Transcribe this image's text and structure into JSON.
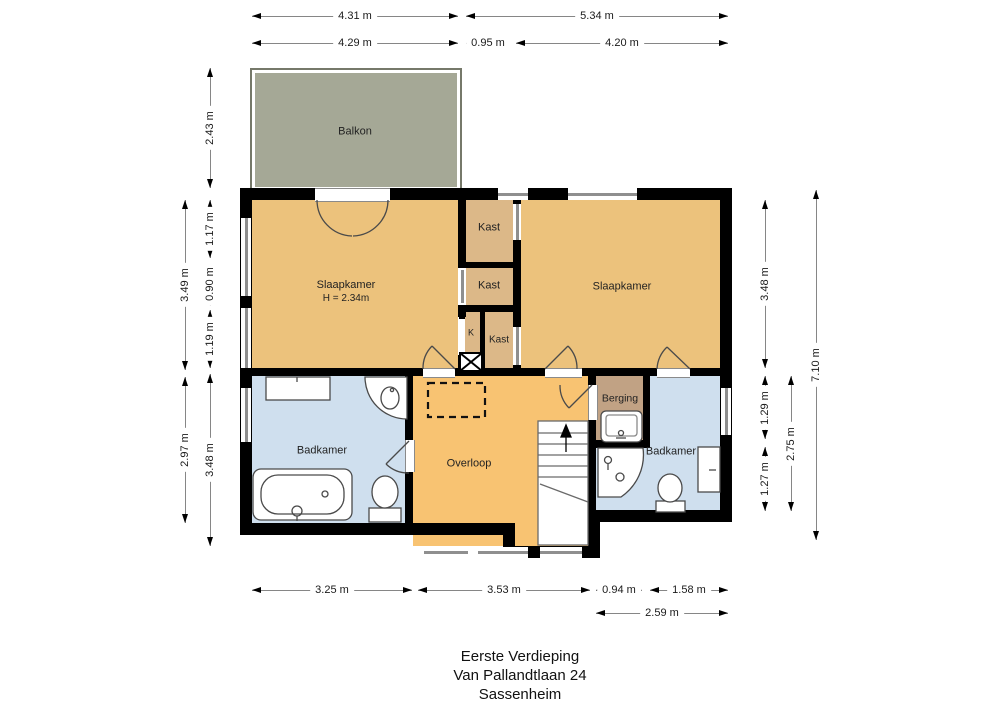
{
  "plan_title": {
    "line1": "Eerste Verdieping",
    "line2": "Van Pallandtlaan 24",
    "line3": "Sassenheim"
  },
  "colors": {
    "wall": "#000000",
    "balkon": "#a5a896",
    "slaapkamer": "#ecc27c",
    "kast": "#dcb888",
    "overloop": "#f8c372",
    "badkamer": "#cfdfee",
    "berging": "#c1a284"
  },
  "rooms": [
    {
      "id": "balkon",
      "label": "Balkon",
      "x": 250,
      "y": 68,
      "w": 208,
      "h": 120,
      "color": "balkon",
      "lx": 355,
      "ly": 132
    },
    {
      "id": "slaapkamer-links",
      "label": "Slaapkamer",
      "sub": "H = 2.34m",
      "x": 252,
      "y": 200,
      "w": 206,
      "h": 168,
      "color": "slaapkamer",
      "lx": 346,
      "ly": 292
    },
    {
      "id": "kast-boven",
      "label": "Kast",
      "x": 466,
      "y": 200,
      "w": 47,
      "h": 62,
      "color": "kast",
      "lx": 489,
      "ly": 228
    },
    {
      "id": "kast-midden",
      "label": "Kast",
      "x": 466,
      "y": 268,
      "w": 47,
      "h": 37,
      "color": "kast",
      "lx": 489,
      "ly": 286
    },
    {
      "id": "k-kast",
      "label": "K",
      "x": 465,
      "y": 312,
      "w": 15,
      "h": 43,
      "color": "kast",
      "lx": 471,
      "ly": 333,
      "fs": 9
    },
    {
      "id": "kast-onder",
      "label": "Kast",
      "x": 485,
      "y": 312,
      "w": 28,
      "h": 56,
      "color": "kast",
      "lx": 499,
      "ly": 340,
      "fs": 10
    },
    {
      "id": "slaapkamer-rechts",
      "label": "Slaapkamer",
      "x": 521,
      "y": 200,
      "w": 199,
      "h": 168,
      "color": "slaapkamer",
      "lx": 622,
      "ly": 287
    },
    {
      "id": "badkamer-links",
      "label": "Badkamer",
      "x": 252,
      "y": 376,
      "w": 153,
      "h": 147,
      "color": "badkamer",
      "lx": 322,
      "ly": 451
    },
    {
      "id": "overloop",
      "label": "Overloop",
      "x": 413,
      "y": 376,
      "w": 175,
      "h": 170,
      "color": "overloop",
      "lx": 469,
      "ly": 464
    },
    {
      "id": "berging",
      "label": "Berging",
      "x": 596,
      "y": 376,
      "w": 47,
      "h": 64,
      "color": "berging",
      "lx": 620,
      "ly": 399,
      "fs": 10.5
    },
    {
      "id": "badkamer-rechts",
      "label": "Badkamer",
      "x": 650,
      "y": 376,
      "w": 70,
      "h": 134,
      "color": "badkamer",
      "lx": 671,
      "ly": 452
    },
    {
      "id": "badkamer-rechts-2",
      "label": "",
      "x": 596,
      "y": 448,
      "w": 54,
      "h": 62,
      "color": "badkamer",
      "lx": 0,
      "ly": 0
    }
  ],
  "dimensions": [
    {
      "label": "4.31 m",
      "o": "h",
      "x": 252,
      "y": 16,
      "len": 206
    },
    {
      "label": "5.34 m",
      "o": "h",
      "x": 466,
      "y": 16,
      "len": 262
    },
    {
      "label": "4.29 m",
      "o": "h",
      "x": 252,
      "y": 43,
      "len": 206
    },
    {
      "label": "0.95 m",
      "o": "h",
      "x": 466,
      "y": 43,
      "len": 44
    },
    {
      "label": "4.20 m",
      "o": "h",
      "x": 516,
      "y": 43,
      "len": 212
    },
    {
      "label": "2.43 m",
      "o": "v",
      "x": 210,
      "y": 68,
      "len": 120
    },
    {
      "label": "1.17 m",
      "o": "v",
      "x": 210,
      "y": 200,
      "len": 58
    },
    {
      "label": "0.90 m",
      "o": "v",
      "x": 210,
      "y": 262,
      "len": 44
    },
    {
      "label": "1.19 m",
      "o": "v",
      "x": 210,
      "y": 310,
      "len": 58
    },
    {
      "label": "3.49 m",
      "o": "v",
      "x": 185,
      "y": 200,
      "len": 170
    },
    {
      "label": "2.97 m",
      "o": "v",
      "x": 185,
      "y": 377,
      "len": 146
    },
    {
      "label": "3.48 m",
      "o": "v",
      "x": 210,
      "y": 374,
      "len": 172
    },
    {
      "label": "3.48 m",
      "o": "v",
      "x": 765,
      "y": 200,
      "len": 168
    },
    {
      "label": "1.29 m",
      "o": "v",
      "x": 765,
      "y": 376,
      "len": 63
    },
    {
      "label": "1.27 m",
      "o": "v",
      "x": 765,
      "y": 447,
      "len": 64
    },
    {
      "label": "2.75 m",
      "o": "v",
      "x": 791,
      "y": 376,
      "len": 135
    },
    {
      "label": "7.10 m",
      "o": "v",
      "x": 816,
      "y": 190,
      "len": 350
    },
    {
      "label": "3.25 m",
      "o": "h",
      "x": 252,
      "y": 590,
      "len": 160
    },
    {
      "label": "3.53 m",
      "o": "h",
      "x": 418,
      "y": 590,
      "len": 172
    },
    {
      "label": "0.94 m",
      "o": "h",
      "x": 596,
      "y": 590,
      "len": 46
    },
    {
      "label": "1.58 m",
      "o": "h",
      "x": 650,
      "y": 590,
      "len": 78
    },
    {
      "label": "2.59 m",
      "o": "h",
      "x": 596,
      "y": 613,
      "len": 132
    }
  ]
}
